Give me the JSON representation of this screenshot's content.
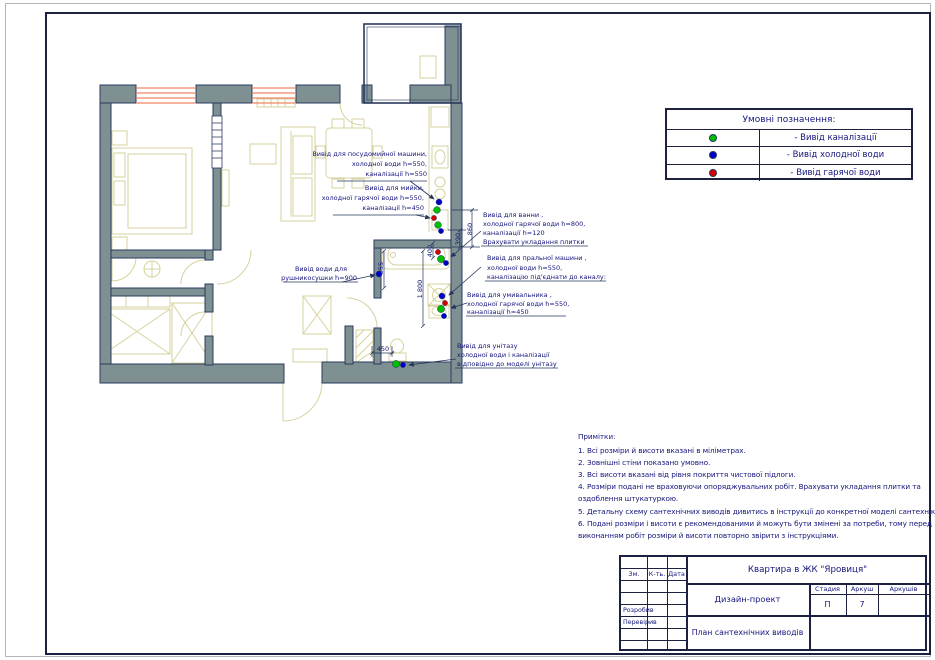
{
  "colors": {
    "sewer": "#00be00",
    "cold": "#0000cd",
    "hot": "#d80000",
    "wall": "#7e9091",
    "window": "#f08868",
    "ink": "#15157c"
  },
  "legend": {
    "title": "Умовні  позначення:",
    "items": [
      {
        "icon": "green-dot",
        "label": "- Вивід   каналізації"
      },
      {
        "icon": "blue-dot",
        "label": "- Вивід холодної  води"
      },
      {
        "icon": "red-dot",
        "label": "- Вивід  гарячої  води"
      }
    ]
  },
  "annotations": {
    "dishwasher": {
      "lines": [
        "Вивід для посудомийної  машини,",
        "холодної  води h=550,",
        "каналізації  h=550"
      ]
    },
    "sink": {
      "lines": [
        "Вивід для   мийки,",
        "холодної гарячої  води   h=550,",
        "каналізації  h=450"
      ]
    },
    "bath": {
      "lines": [
        "Вивід для ванни ,",
        "холодної гарячої води      h=800,",
        "каналізації  h=120",
        "Врахувати укладання плитки"
      ]
    },
    "washing_machine": {
      "lines": [
        "Вивід для пральної машини ,",
        "холодної  води h=550,",
        "каналізацію під'єднати до каналу:"
      ]
    },
    "washbasin": {
      "lines": [
        "Вивід для умивальника ,",
        "холодної гарячої   води h=550,",
        "каналізації  h=450"
      ]
    },
    "toilet": {
      "lines": [
        "Вивід для унітазу",
        "холодної  води і каналізації",
        "відповідно до моделі унітазу"
      ]
    },
    "towel_dryer": {
      "lines": [
        "Вивід води для",
        "рушникосушки  h=900"
      ]
    }
  },
  "dims": {
    "d860": "860",
    "d390": "390",
    "d400": "400",
    "d855": "855",
    "d1800": "1 800",
    "d450": "450"
  },
  "notes": {
    "title": "Примітки:",
    "lines": [
      "1. Всі розміри й висоти  вказані в міліметрах.",
      "2. Зовнішні  стіни показано умовно.",
      "3. Всі висоти  вказані від рівня покриття чистової  підлоги.",
      "4. Розміри  подані не враховуючи опоряджувальних робіт. Врахувати укладання плитки та",
      "оздоблення штукатуркою.",
      "5. Детальну  схему  сантехнічних виводів  дивитись  в інструкції  до  конкретної  моделі  сантехніки.",
      "6. Подані  розміри і висоти є рекомендованими й можуть  бути змінені  за потреби, тому перед",
      "виконанням   робіт  розміри й висоти повторно звірити з інструкціями."
    ]
  },
  "title_block": {
    "project": "Квартира в ЖК \"Яровиця\"",
    "doc_type": "Дизайн-проект",
    "sheet_title": "План сантехнічних виводів",
    "col_change": "Зм.",
    "col_qty": "К-ть.",
    "col_date": "Дата",
    "stage_label": "Стадия",
    "sheet_label": "Аркуш",
    "sheets_label": "Аркушів",
    "stage_value": "П",
    "sheet_value": "7",
    "role_developed": "Розробив",
    "role_checked": "Перевірив"
  }
}
